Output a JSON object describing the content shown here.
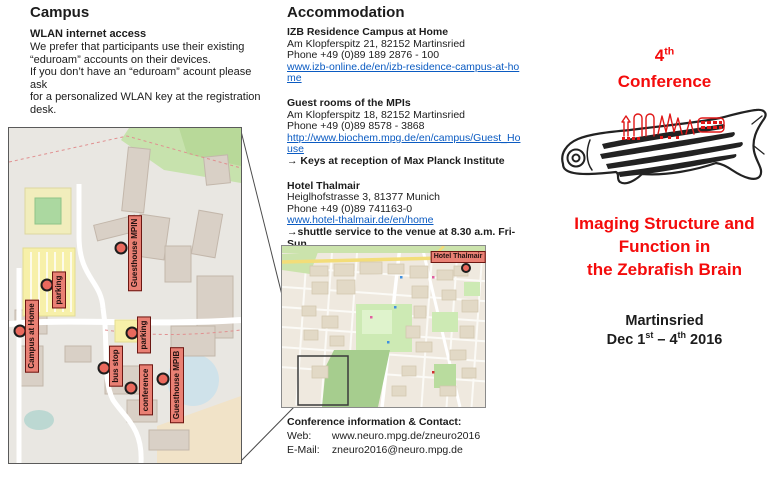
{
  "colors": {
    "accent_red": "#f40b0b",
    "link_blue": "#0b5bc2",
    "marker_fill": "#e98074",
    "marker_border": "#6b1712",
    "dot_fill": "#ea695d"
  },
  "campus": {
    "heading": "Campus",
    "wlan_title": "WLAN internet access",
    "wlan_lines": [
      "We prefer that participants use their existing",
      "“eduroam” accounts on their devices.",
      "If you don’t have an “eduroam” acount please ask",
      "for a personalized WLAN key at the registration",
      "desk."
    ],
    "map": {
      "markers": [
        "Guesthouse MPIN",
        "parking",
        "Campus at Home",
        "parking",
        "bus stop",
        "conference",
        "Guesthouse MPIB"
      ]
    }
  },
  "accommodation": {
    "heading": "Accommodation",
    "entries": [
      {
        "name": "IZB Residence Campus at Home",
        "address": "Am Klopferspitz 21, 82152 Martinsried",
        "phone": "Phone +49 (0)89 189 2876 - 100",
        "link": "www.izb-online.de/en/izb-residence-campus-at-home"
      },
      {
        "name": "Guest rooms of the MPIs",
        "address": "Am Klopferspitz 18, 82152 Martinsried",
        "phone": "Phone +49 (0)89 8578 - 3868",
        "link": "http://www.biochem.mpg.de/en/campus/Guest_House",
        "note": "→ Keys at reception of Max Planck Institute"
      },
      {
        "name": "Hotel Thalmair",
        "address": "Heiglhofstrasse 3, 81377 Munich",
        "phone": "Phone +49 (0)89 741163-0",
        "link": "www.hotel-thalmair.de/en/home",
        "note": "→shuttle service to the venue at 8.30 a.m. Fri-Sun"
      }
    ],
    "city_map_label": "Hotel Thalmair",
    "contact": {
      "title": "Conference information & Contact:",
      "web_label": "Web:",
      "web_value": "www.neuro.mpg.de/zneuro2016",
      "email_label": "E-Mail:",
      "email_value": "zneuro2016@neuro.mpg.de"
    }
  },
  "conference": {
    "number": "4",
    "number_suffix": "th",
    "title_word": "Conference",
    "main_title_lines": [
      "Imaging Structure and",
      "Function in",
      "the Zebrafish Brain"
    ],
    "location": "Martinsried",
    "date_parts": [
      "Dec 1",
      "st",
      " – 4",
      "th",
      " 2016"
    ]
  }
}
